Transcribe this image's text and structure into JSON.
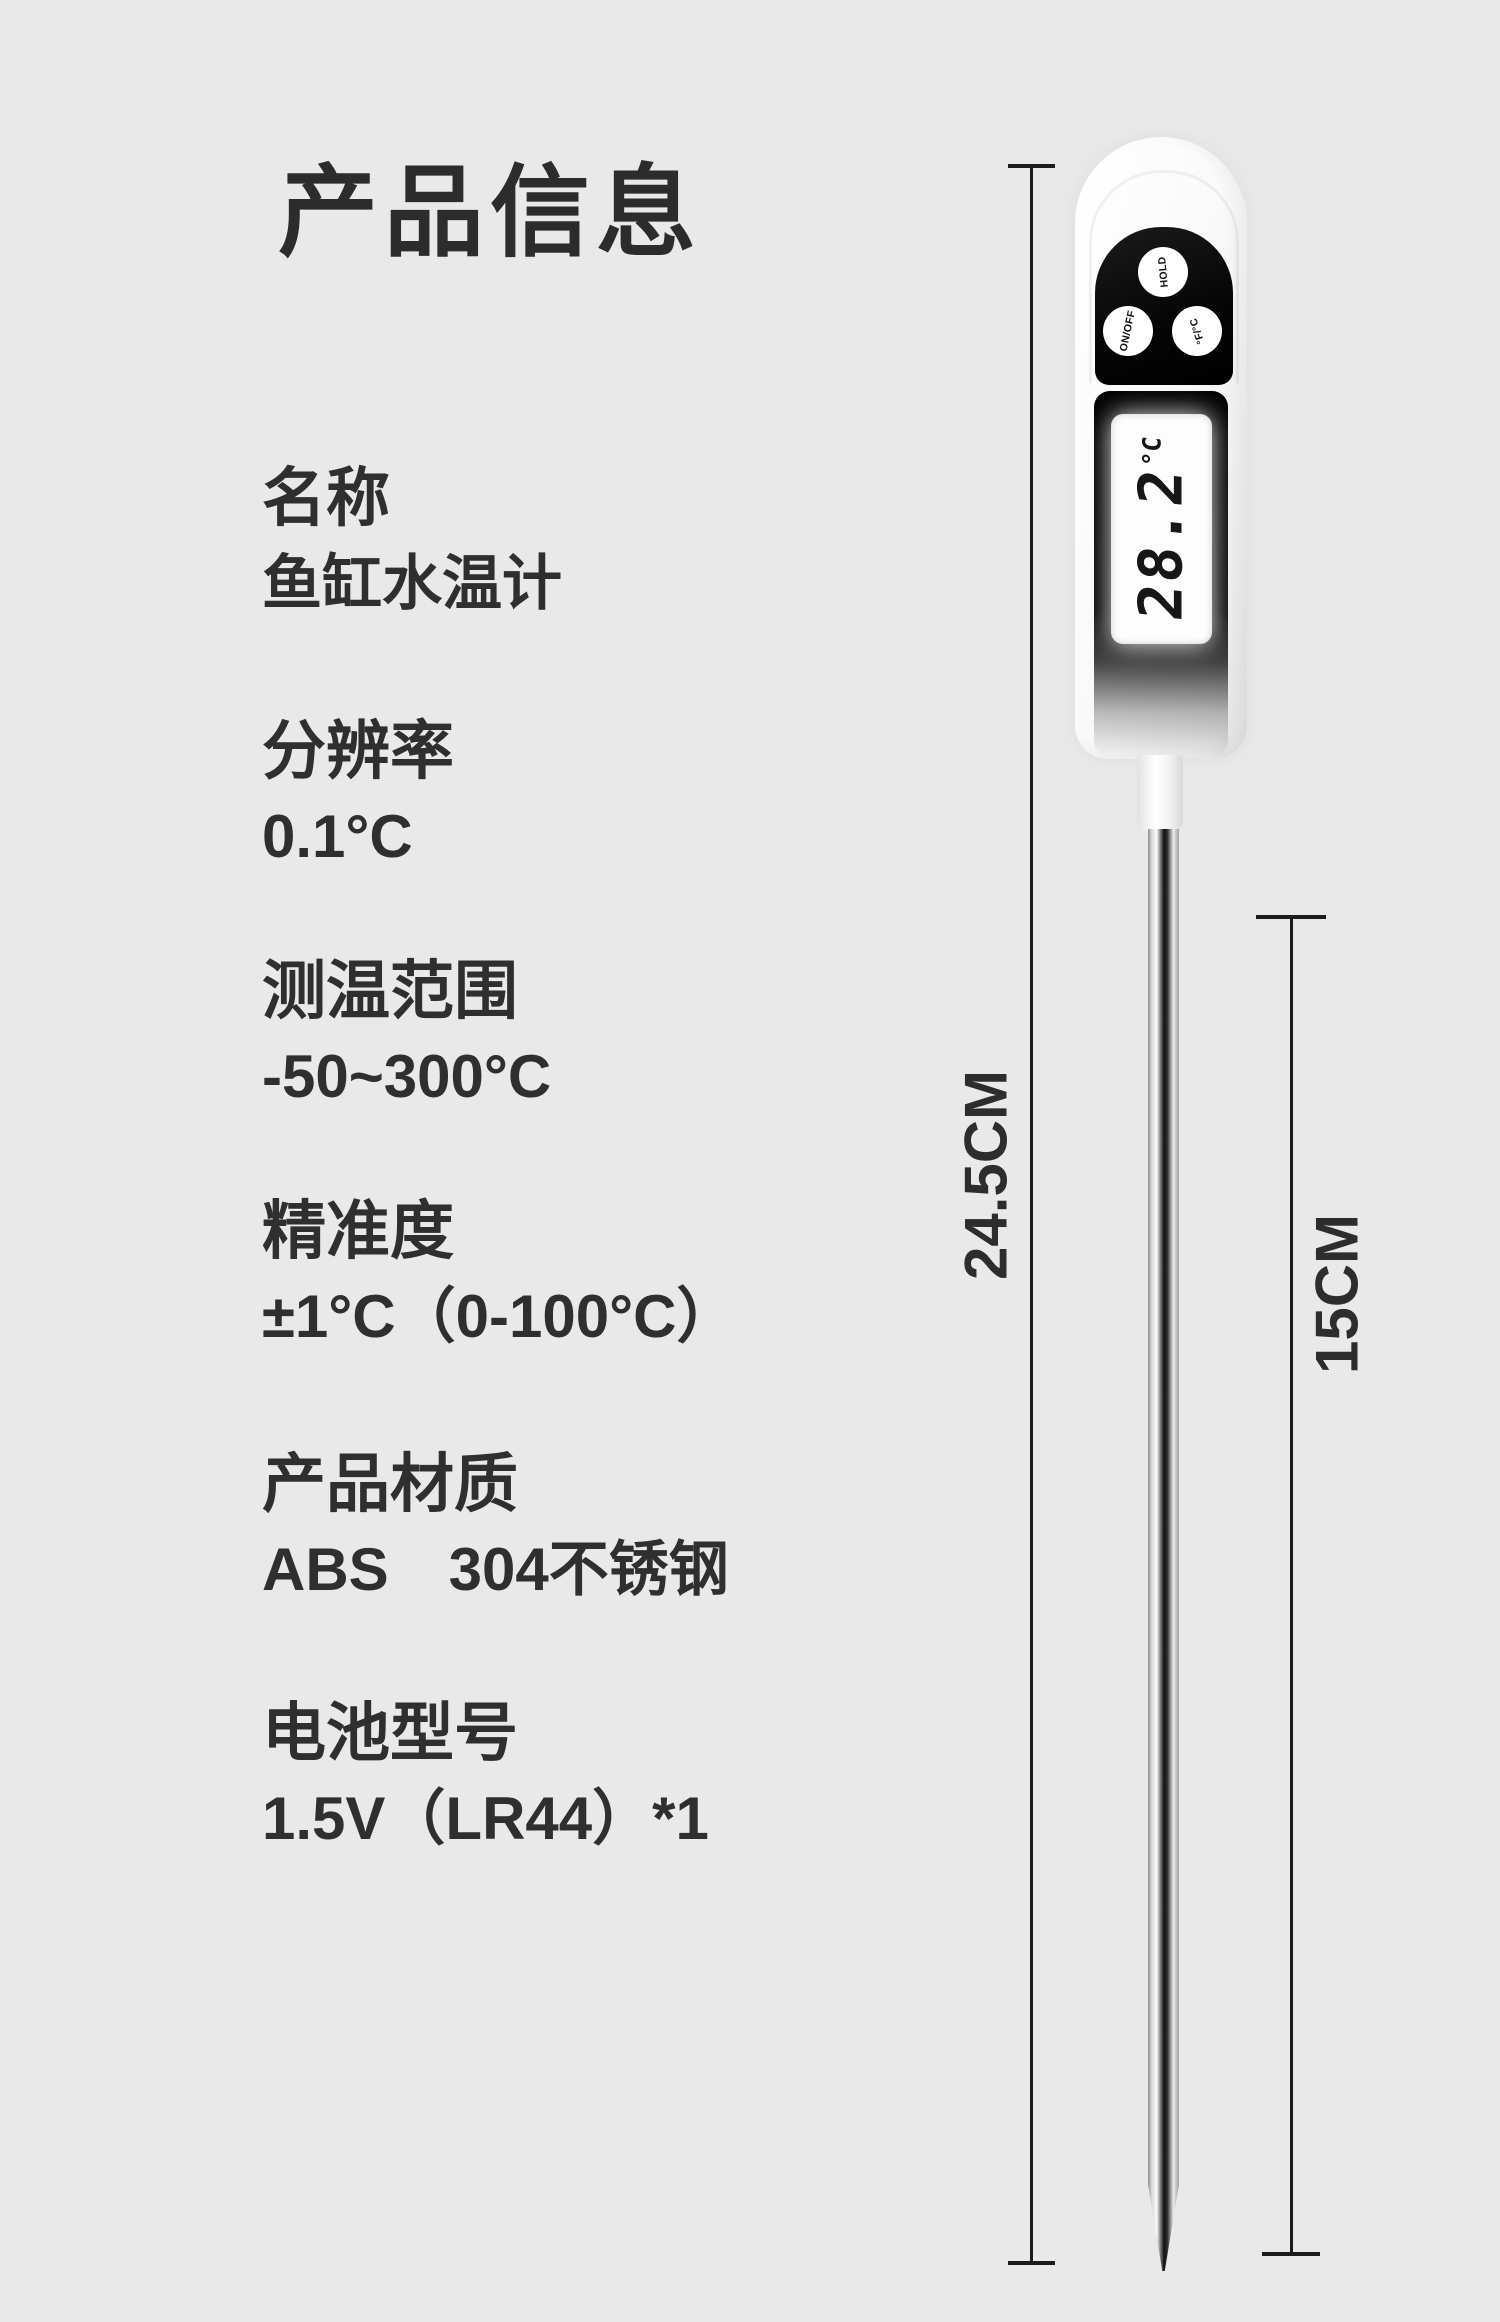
{
  "page": {
    "title": "产品信息"
  },
  "specs": [
    {
      "label": "名称",
      "value": "鱼缸水温计"
    },
    {
      "label": "分辨率",
      "value": "0.1°C"
    },
    {
      "label": "测温范围",
      "value": "-50~300°C"
    },
    {
      "label": "精准度",
      "value": "±1°C（0-100°C）"
    },
    {
      "label": "产品材质",
      "value": "ABS　304不锈钢"
    },
    {
      "label": "电池型号",
      "value": "1.5V（LR44）*1"
    }
  ],
  "thermometer": {
    "buttons": [
      {
        "label": "HOLD"
      },
      {
        "label": "ON/OFF"
      },
      {
        "label": "°F/°C"
      }
    ],
    "lcd": {
      "reading": "28.2",
      "unit": "°C"
    }
  },
  "dimensions": {
    "overall_length": "24.5CM",
    "probe_length": "15CM"
  },
  "colors": {
    "background": "#e9e9e9",
    "text": "#2f2f2f",
    "annotation": "#1c1c1c",
    "head": "#0c0c0c",
    "lcd_background": "#fdfdfd"
  }
}
